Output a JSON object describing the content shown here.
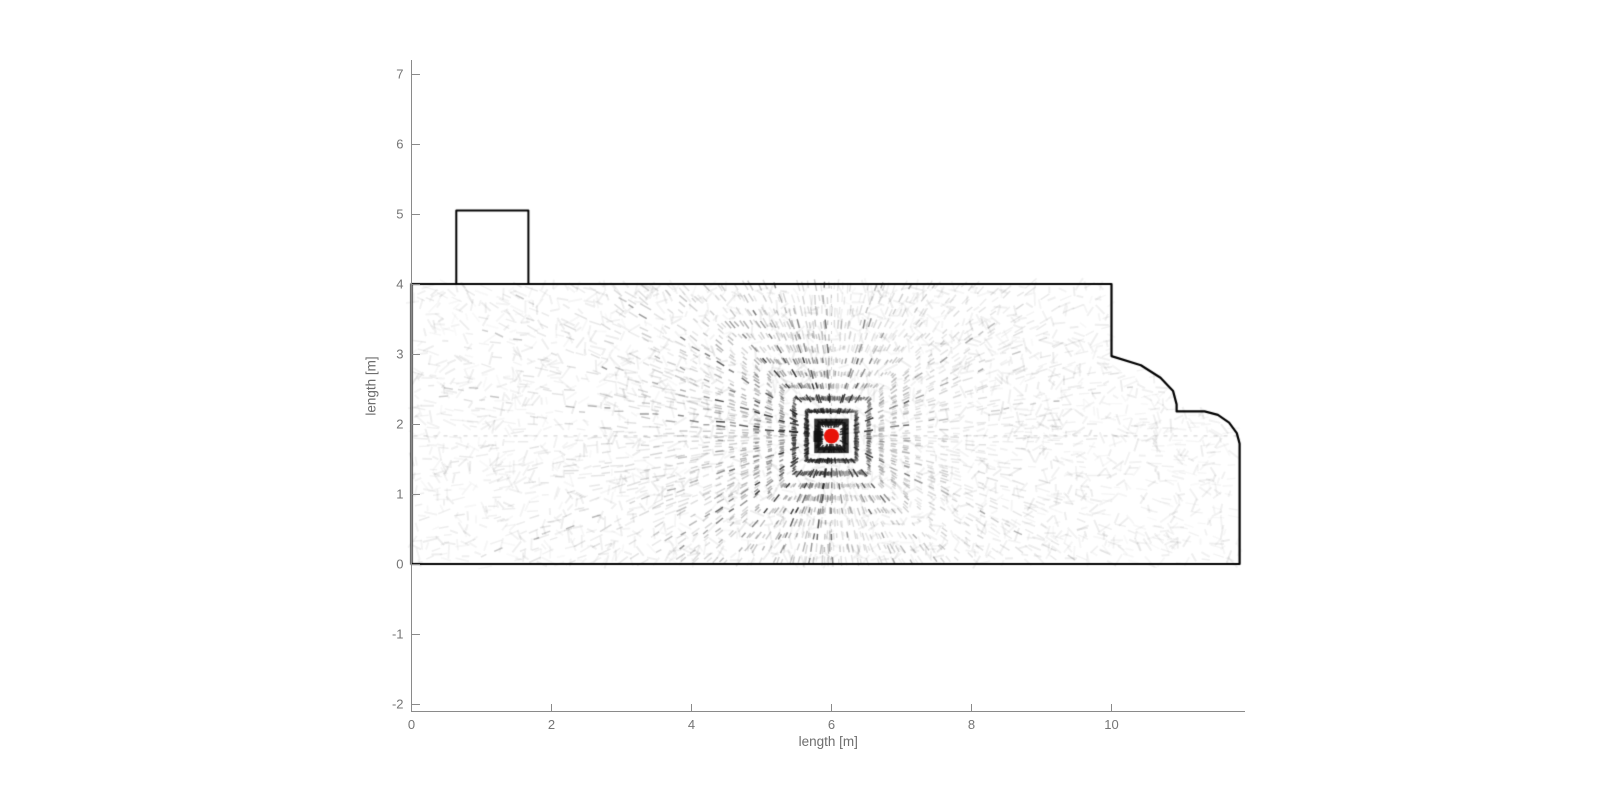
{
  "figure": {
    "width": 1600,
    "height": 803,
    "background": "#ffffff"
  },
  "axes": {
    "xlabel": "length [m]",
    "ylabel": "length [m]",
    "xticks": {
      "values": [
        0,
        2,
        4,
        6,
        8,
        10
      ],
      "labels": [
        "0",
        "2",
        "4",
        "6",
        "8",
        "10"
      ]
    },
    "yticks": {
      "values": [
        -2,
        -1,
        0,
        1,
        2,
        3,
        4,
        5,
        6,
        7
      ],
      "labels": [
        "-2",
        "-1",
        "0",
        "1",
        "2",
        "3",
        "4",
        "5",
        "6",
        "7"
      ]
    },
    "xlim": [
      0,
      11.9
    ],
    "ylim": [
      -2.1,
      7.2
    ],
    "axis_color": "#8a8a8a",
    "tick_label_color": "#757575",
    "label_color": "#6e6e6e"
  },
  "chart_data": {
    "type": "scatter",
    "title": "",
    "xlabel": "length [m]",
    "ylabel": "length [m]",
    "xlim": [
      0,
      11.9
    ],
    "ylim": [
      -2.1,
      7.2
    ],
    "grid": false,
    "legend": null,
    "room_outline_m": [
      [
        0,
        0
      ],
      [
        0,
        4
      ],
      [
        10,
        4
      ],
      [
        10,
        2.97
      ],
      [
        10.42,
        2.84
      ],
      [
        10.7,
        2.66
      ],
      [
        10.88,
        2.47
      ],
      [
        10.93,
        2.28
      ],
      [
        10.93,
        2.18
      ],
      [
        11.33,
        2.18
      ],
      [
        11.52,
        2.13
      ],
      [
        11.68,
        2.02
      ],
      [
        11.79,
        1.87
      ],
      [
        11.83,
        1.72
      ],
      [
        11.83,
        0
      ]
    ],
    "chimney_rect_m": {
      "x": 0.64,
      "y": 4.0,
      "w": 1.03,
      "h": 1.05
    },
    "sensor_m": {
      "x": 6.0,
      "y": 1.83
    },
    "sensor_marker": {
      "shape": "filled-circle",
      "color": "#e81309",
      "radius_px": 7.5
    },
    "scan_texture": {
      "num_rays": 252,
      "chebyshev_ring_step_m": 0.178,
      "max_rings": 40,
      "ink_color": "#1a1a1a",
      "center_cross": true
    },
    "outline_color": "#000000",
    "outline_width_px": 2.2
  }
}
